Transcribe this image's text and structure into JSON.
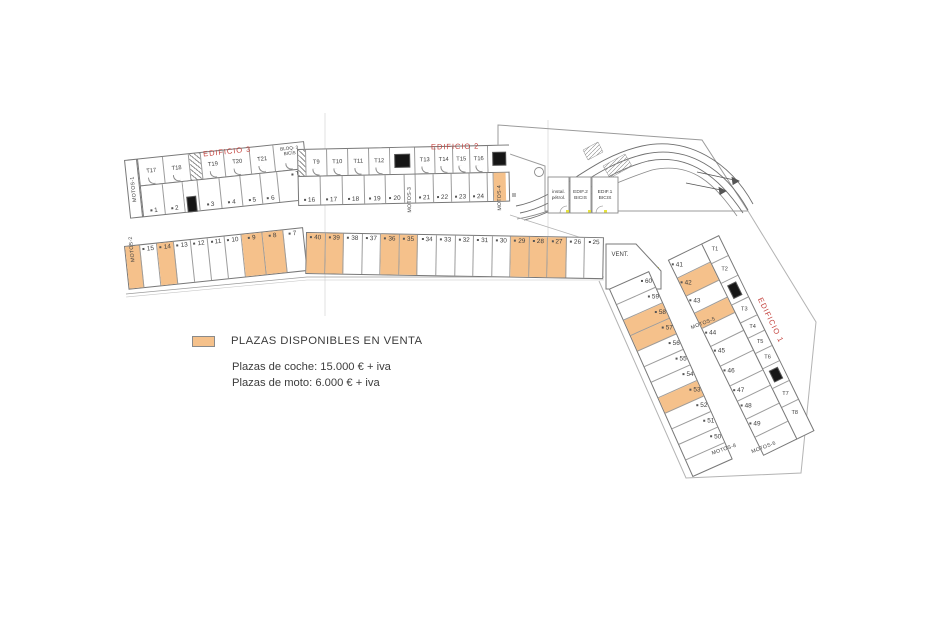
{
  "colors": {
    "available": "#F5C18B",
    "red_label": "#C4443F",
    "wall": "#787878"
  },
  "legend": {
    "title": "PLAZAS DISPONIBLES EN VENTA",
    "coche": "Plazas de coche: 15.000 € + iva",
    "moto": "Plazas de moto: 6.000 € + iva"
  },
  "labels": {
    "edificio3": "EDIFICIO 3",
    "edificio2": "EDIFICIO 2",
    "edificio1": "EDIFICIO 1",
    "vent": "VENT.",
    "motos1": "MOTOS-1",
    "instal_l1": "instal.",
    "instal_l2": "pétrol.",
    "edif2b_l1": "EDIF.2",
    "edif2b_l2": "BICIS",
    "edif1b_l1": "EDIF.1",
    "edif1b_l2": "BICIS"
  },
  "rows": {
    "b3_top": [
      {
        "t": "T17",
        "w": 25,
        "k": "storage-room"
      },
      {
        "t": "T18",
        "w": 26,
        "k": "storage-room"
      },
      {
        "hatch": true,
        "w": 12,
        "k": "stairs"
      },
      {
        "t": "T19",
        "w": 23,
        "k": "storage-room"
      },
      {
        "t": "T20",
        "w": 26,
        "k": "storage-room"
      },
      {
        "t": "T21",
        "w": 24,
        "k": "storage-room"
      },
      {
        "t": "BLOQ- 3",
        "t2": "BICIS",
        "w": 31,
        "k": "bike-room",
        "cls": "bloq"
      }
    ],
    "b3_bottom": [
      {
        "t": "1",
        "w": 22,
        "k": "parking-space"
      },
      {
        "t": "2",
        "w": 20,
        "k": "parking-space"
      },
      {
        "elev": true,
        "w": 15,
        "k": "elevator-core"
      },
      {
        "t": "3",
        "w": 22,
        "k": "parking-space"
      },
      {
        "t": "4",
        "w": 21,
        "k": "parking-space"
      },
      {
        "t": "5",
        "w": 20,
        "k": "parking-space"
      },
      {
        "t": "6",
        "w": 17,
        "k": "parking-space"
      },
      {
        "t": "T22",
        "w": 30,
        "k": "storage-room",
        "cls": "t22"
      }
    ],
    "b2_top": [
      {
        "hatch": true,
        "w": 8,
        "k": "stairs"
      },
      {
        "t": "T9",
        "w": 21,
        "k": "storage-room"
      },
      {
        "t": "T10",
        "w": 21,
        "k": "storage-room"
      },
      {
        "t": "T11",
        "w": 21,
        "k": "storage-room"
      },
      {
        "t": "T12",
        "w": 21,
        "k": "storage-room"
      },
      {
        "elev": true,
        "w": 25,
        "k": "elevator-core"
      },
      {
        "t": "T13",
        "w": 20,
        "k": "storage-room"
      },
      {
        "t": "T14",
        "w": 18,
        "k": "storage-room"
      },
      {
        "t": "T15",
        "w": 17,
        "k": "storage-room"
      },
      {
        "t": "T16",
        "w": 18,
        "k": "storage-room"
      },
      {
        "elev": true,
        "w": 22,
        "k": "elevator-core"
      }
    ],
    "b2_bottom": [
      {
        "t": "16",
        "w": 22,
        "k": "parking-space"
      },
      {
        "t": "17",
        "w": 22,
        "k": "parking-space"
      },
      {
        "t": "18",
        "w": 22,
        "k": "parking-space"
      },
      {
        "t": "19",
        "w": 21,
        "k": "parking-space"
      },
      {
        "t": "20",
        "w": 19,
        "k": "parking-space"
      },
      {
        "t": "MOTOS-3",
        "v": true,
        "w": 11,
        "k": "moto-parking-strip"
      },
      {
        "t": "21",
        "w": 18,
        "k": "parking-space"
      },
      {
        "t": "22",
        "w": 18,
        "k": "parking-space"
      },
      {
        "t": "23",
        "w": 18,
        "k": "parking-space"
      },
      {
        "t": "24",
        "w": 18,
        "k": "parking-space"
      },
      {
        "t": "",
        "w": 6,
        "k": "wall-gap"
      },
      {
        "t": "MOTOS-4",
        "v": true,
        "a": true,
        "w": 12,
        "k": "moto-parking-strip"
      }
    ],
    "mid_left": [
      {
        "t": "MOTOS-2",
        "v": true,
        "a": true,
        "w": 15,
        "k": "moto-parking-strip"
      },
      {
        "t": "15",
        "w": 17,
        "k": "parking-space"
      },
      {
        "t": "14",
        "a": true,
        "w": 17,
        "k": "parking-space"
      },
      {
        "t": "13",
        "w": 17,
        "k": "parking-space"
      },
      {
        "t": "12",
        "w": 17,
        "k": "parking-space"
      },
      {
        "t": "11",
        "w": 17,
        "k": "parking-space"
      },
      {
        "t": "10",
        "w": 17,
        "k": "parking-space"
      },
      {
        "t": "9",
        "a": true,
        "w": 21,
        "k": "parking-space"
      },
      {
        "t": "8",
        "a": true,
        "w": 21,
        "k": "parking-space"
      },
      {
        "t": "7",
        "w": 18,
        "k": "parking-space"
      }
    ],
    "mid_right": [
      {
        "t": "40",
        "a": true,
        "k": "parking-space"
      },
      {
        "t": "39",
        "a": true,
        "k": "parking-space"
      },
      {
        "t": "38",
        "k": "parking-space"
      },
      {
        "t": "37",
        "k": "parking-space"
      },
      {
        "t": "36",
        "a": true,
        "k": "parking-space"
      },
      {
        "t": "35",
        "a": true,
        "k": "parking-space"
      },
      {
        "t": "34",
        "k": "parking-space"
      },
      {
        "t": "33",
        "k": "parking-space"
      },
      {
        "t": "32",
        "k": "parking-space"
      },
      {
        "t": "31",
        "k": "parking-space"
      },
      {
        "t": "30",
        "k": "parking-space"
      },
      {
        "t": "29",
        "a": true,
        "k": "parking-space"
      },
      {
        "t": "28",
        "a": true,
        "k": "parking-space"
      },
      {
        "t": "27",
        "a": true,
        "k": "parking-space"
      },
      {
        "t": "26",
        "k": "parking-space"
      },
      {
        "t": "25",
        "k": "parking-space"
      }
    ],
    "strip_a": [
      {
        "t": "60",
        "w": 17,
        "k": "parking-space"
      },
      {
        "t": "59",
        "w": 17,
        "k": "parking-space"
      },
      {
        "t": "58",
        "a": true,
        "w": 17,
        "k": "parking-space"
      },
      {
        "t": "57",
        "a": true,
        "w": 17,
        "k": "parking-space"
      },
      {
        "t": "56",
        "w": 17,
        "k": "parking-space"
      },
      {
        "t": "55",
        "w": 17,
        "k": "parking-space"
      },
      {
        "t": "54",
        "w": 17,
        "k": "parking-space"
      },
      {
        "t": "53",
        "a": true,
        "w": 17,
        "k": "parking-space"
      },
      {
        "t": "52",
        "w": 17,
        "k": "parking-space"
      },
      {
        "t": "51",
        "w": 17,
        "k": "parking-space"
      },
      {
        "t": "50",
        "w": 17,
        "k": "parking-space"
      },
      {
        "t": "MOTOS-8",
        "axis": true,
        "w": 19,
        "k": "moto-parking-strip"
      }
    ],
    "b1_t": [
      {
        "t": "T1",
        "w": 22,
        "k": "storage-room"
      },
      {
        "t": "T2",
        "w": 22,
        "k": "storage-room"
      },
      {
        "elev": true,
        "w": 24,
        "k": "elevator-core"
      },
      {
        "t": "T3",
        "w": 20,
        "k": "storage-room"
      },
      {
        "t": "T4",
        "w": 17,
        "k": "storage-room"
      },
      {
        "t": "T5",
        "w": 17,
        "k": "storage-room"
      },
      {
        "t": "T6",
        "w": 17,
        "k": "storage-room"
      },
      {
        "elev": true,
        "w": 22,
        "k": "elevator-core"
      },
      {
        "t": "T7",
        "w": 21,
        "k": "storage-room"
      },
      {
        "t": "T8",
        "w": 21,
        "k": "storage-room"
      }
    ],
    "b1_inner": [
      {
        "t": "41",
        "w": 20,
        "k": "parking-space"
      },
      {
        "t": "42",
        "a": true,
        "w": 20,
        "k": "parking-space"
      },
      {
        "t": "43",
        "w": 19,
        "k": "parking-space"
      },
      {
        "t": "MOTOS-5",
        "axis": true,
        "a": true,
        "w": 17,
        "k": "moto-parking-strip"
      },
      {
        "t": "44",
        "w": 20,
        "k": "parking-space"
      },
      {
        "t": "45",
        "w": 22,
        "k": "parking-space"
      },
      {
        "t": "46",
        "w": 22,
        "k": "parking-space"
      },
      {
        "t": "47",
        "w": 17,
        "k": "parking-space"
      },
      {
        "t": "48",
        "w": 20,
        "k": "parking-space"
      },
      {
        "t": "49",
        "w": 20,
        "k": "parking-space"
      },
      {
        "t": "MOTOS-6",
        "axis": true,
        "w": 18,
        "k": "moto-parking-strip"
      }
    ]
  }
}
